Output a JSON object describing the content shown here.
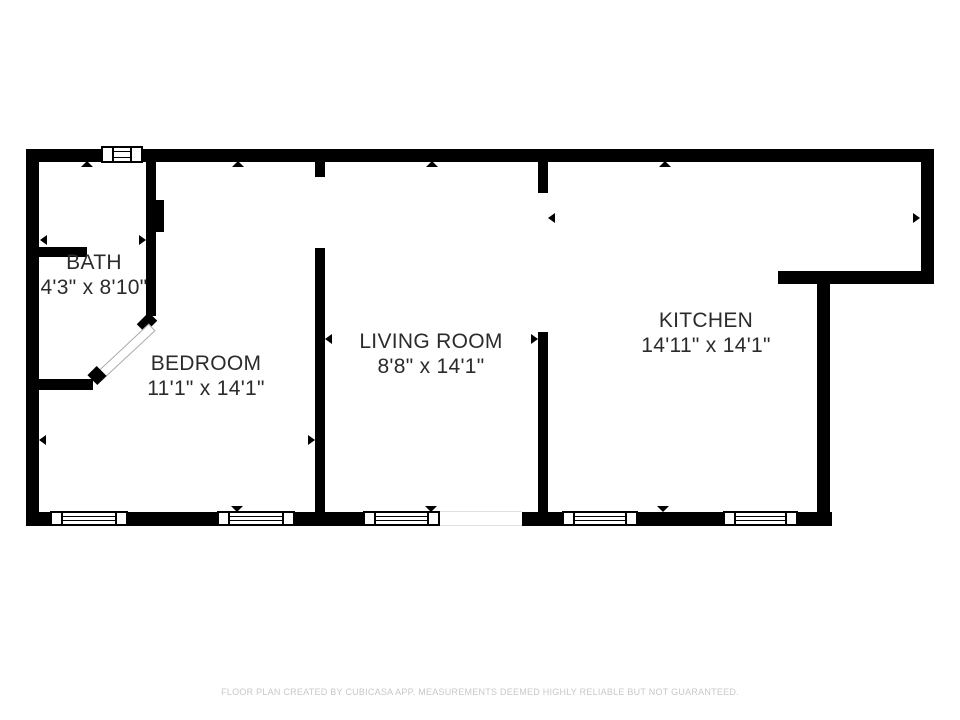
{
  "rooms": {
    "bath": {
      "name": "BATH",
      "dims": "4'3\" x 8'10\""
    },
    "bedroom": {
      "name": "BEDROOM",
      "dims": "11'1\" x 14'1\""
    },
    "living": {
      "name": "LIVING ROOM",
      "dims": "8'8\" x 14'1\""
    },
    "kitchen": {
      "name": "KITCHEN",
      "dims": "14'11\" x 14'1\""
    }
  },
  "footer": {
    "disclaimer": "FLOOR PLAN CREATED BY CUBICASA APP. MEASUREMENTS DEEMED HIGHLY RELIABLE BUT NOT GUARANTEED."
  },
  "icons": {
    "window": "rect-frame-with-mullions",
    "door-swing": "rotated-white-leaf-with-black-jambs",
    "opening-marker": "small-black-triangle",
    "measure-arrow": "small-black-side-triangle"
  },
  "colors": {
    "wall": "#000000",
    "room_text": "#2b2b2b",
    "footer_text": "#c8c8c8",
    "background": "#ffffff",
    "threshold_line": "#e0e0e0"
  }
}
